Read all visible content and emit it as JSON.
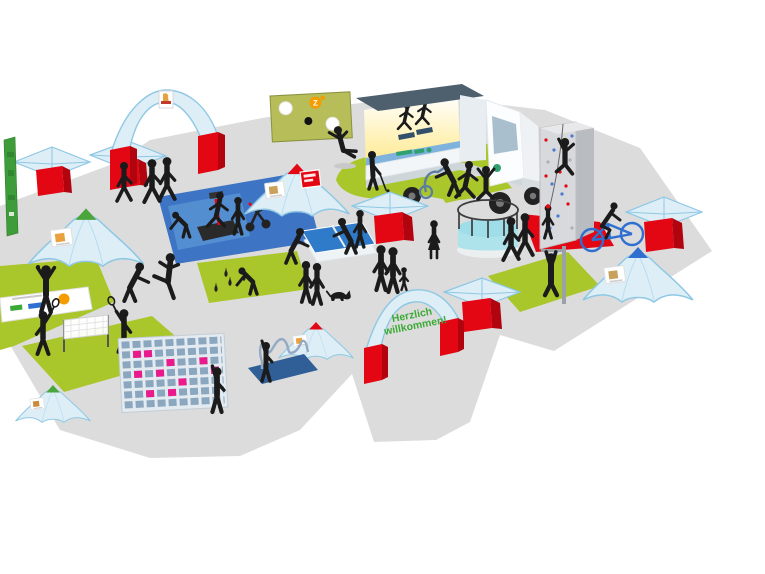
{
  "palette": {
    "background": "#ffffff",
    "ground": "#dcdcdc",
    "grass": "#a9c62b",
    "accent_red": "#e30613",
    "tent_blue": "#ddeef7",
    "tent_edge": "#8fc8e4",
    "mat_blue": "#3d74c4",
    "trampoline_cyan": "#9fdde8",
    "goal_wall_olive": "#b6bd59",
    "logo_orange": "#f59c00",
    "target_pink": "#ea1a8c",
    "silhouette": "#1b1b1b",
    "welcome_green": "#3aaa35",
    "truck_logo_green": "#2fa170"
  },
  "welcome_arch": {
    "line1": "Herzlich",
    "line2": "willkommen!"
  },
  "goal_wall": {
    "logo_text": "Z"
  },
  "stations": [
    {
      "name": "entrance-arch"
    },
    {
      "name": "folded-canopy-counters"
    },
    {
      "name": "beach-flag"
    },
    {
      "name": "goal-wall-shooting"
    },
    {
      "name": "event-truck-stage"
    },
    {
      "name": "treadmill-demo"
    },
    {
      "name": "putting-green"
    },
    {
      "name": "fitness-equipment-mat"
    },
    {
      "name": "table-tennis"
    },
    {
      "name": "trampoline"
    },
    {
      "name": "climbing-tower"
    },
    {
      "name": "bike-course"
    },
    {
      "name": "pull-up-bar"
    },
    {
      "name": "dome-tent-left"
    },
    {
      "name": "dome-tent-center"
    },
    {
      "name": "dome-tent-south"
    },
    {
      "name": "dome-tent-right"
    },
    {
      "name": "dome-tent-small"
    },
    {
      "name": "serve-court-with-banner"
    },
    {
      "name": "badminton-court"
    },
    {
      "name": "martial-arts-demo"
    },
    {
      "name": "club-toss-mat"
    },
    {
      "name": "target-grid-wall"
    },
    {
      "name": "hot-wire-game"
    },
    {
      "name": "welcome-arch"
    }
  ]
}
